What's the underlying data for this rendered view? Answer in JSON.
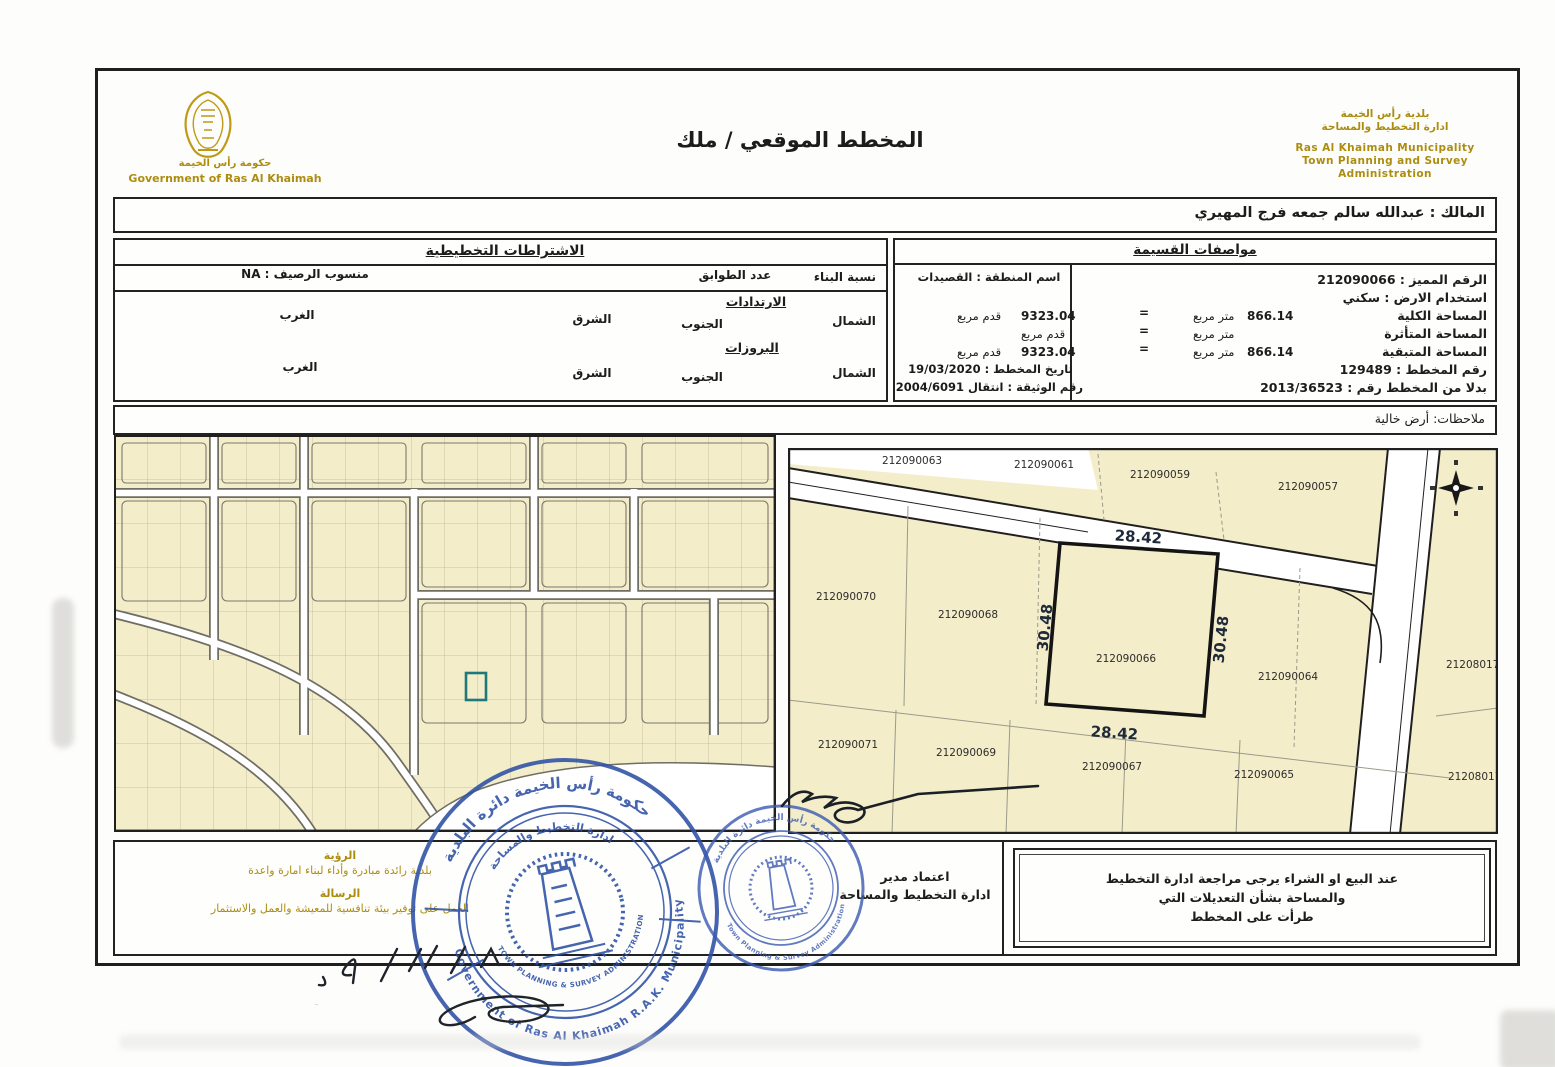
{
  "logo": {
    "arabic": "حكومة رأس الخيمة",
    "english": "Government of Ras Al Khaimah"
  },
  "title": "المخطط الموقعي / ملك",
  "municipality": {
    "ar1": "بلدية رأس الخيمة",
    "ar2": "ادارة التخطيط والمساحة",
    "en1": "Ras Al Khaimah Municipality",
    "en2": "Town Planning and Survey",
    "en3": "Administration"
  },
  "owner": {
    "line": "المالك : عبدالله سالم جمعه فرج المهيري"
  },
  "planning": {
    "title": "الاشتراطات التخطيطية",
    "building_ratio": "نسبة البناء",
    "floors": "عدد الطوابق",
    "pavement_level": "منسوب الرصيف : NA",
    "setbacks": "الارتدادات",
    "projections": "البروزات",
    "north": "الشمال",
    "south": "الجنوب",
    "east": "الشرق",
    "west": "الغرب"
  },
  "specs": {
    "title": "مواصفات القسيمة",
    "unique_no": "الرقم المميز : 212090066",
    "land_use": "استخدام الارض : سكني",
    "total_label": "المساحة الكلية",
    "affected_label": "المساحة المتأثرة",
    "remaining_label": "المساحة المتبقية",
    "total_m2": "866.14",
    "remaining_m2": "866.14",
    "sqm": "متر مربع",
    "eq": "=",
    "plan_no": "رقم المخطط : 129489",
    "replaces": "بدلا من المخطط رقم : 2013/36523",
    "area_name": "اسم المنطقة : القصيدات",
    "total_ft2": "9323.04",
    "remaining_ft2": "9323.04",
    "sqft": "قدم مربع",
    "plan_date": "تاريخ المخطط : 19/03/2020",
    "doc_no": "رقم الوثيقة : انتقال 2004/6091"
  },
  "notes": {
    "line": "ملاحظات: أرض خالية"
  },
  "site_map": {
    "highlight": "212090066",
    "dim_top": "28.42",
    "dim_bottom": "28.42",
    "dim_left": "30.48",
    "dim_right": "30.48",
    "p063": "212090063",
    "p061": "212090061",
    "p059": "212090059",
    "p057": "212090057",
    "p070": "212090070",
    "p068": "212090068",
    "p064": "212090064",
    "p071": "212090071",
    "p069": "212090069",
    "p067": "212090067",
    "p065": "212090065",
    "p171": "212080171",
    "p172": "212080172"
  },
  "footer": {
    "vision_title": "الرؤية",
    "vision": "بلدية رائدة مبادرة وأداء لبناء امارة واعدة",
    "mission_title": "الرسالة",
    "mission": "العمل على توفير بيئة تنافسية للمعيشة والعمل والاستثمار",
    "approval1": "اعتماد مدير",
    "approval2": "ادارة التخطيط والمساحة",
    "note1": "عند البيع او الشراء يرجى مراجعة ادارة التخطيط",
    "note2": "والمساحة بشأن التعديلات التي",
    "note3": "طرأت على المخطط"
  },
  "stamp_big": {
    "ar_top": "حكومة رأس الخيمة دائرة البلدية",
    "en_bottom": "Government of Ras Al Khaimah R.A.K. Municipality",
    "inner_ar": "ادارة التخطيط والمساحة",
    "inner_en": "TOWN PLANNING & SURVEY ADMINISTRATION"
  },
  "stamp_small": {
    "ar_top": "حكومة رأس الخيمة دائرة البلدية",
    "en_bottom": "Town Planning & Survey Administration"
  },
  "handwriting": {
    "date_marks": "٤/١١/٨"
  },
  "colors": {
    "gold": "#ad8d10",
    "stamp_blue": "#2d50a5",
    "parcel": "#f4edca",
    "teal": "#1d7a78"
  }
}
